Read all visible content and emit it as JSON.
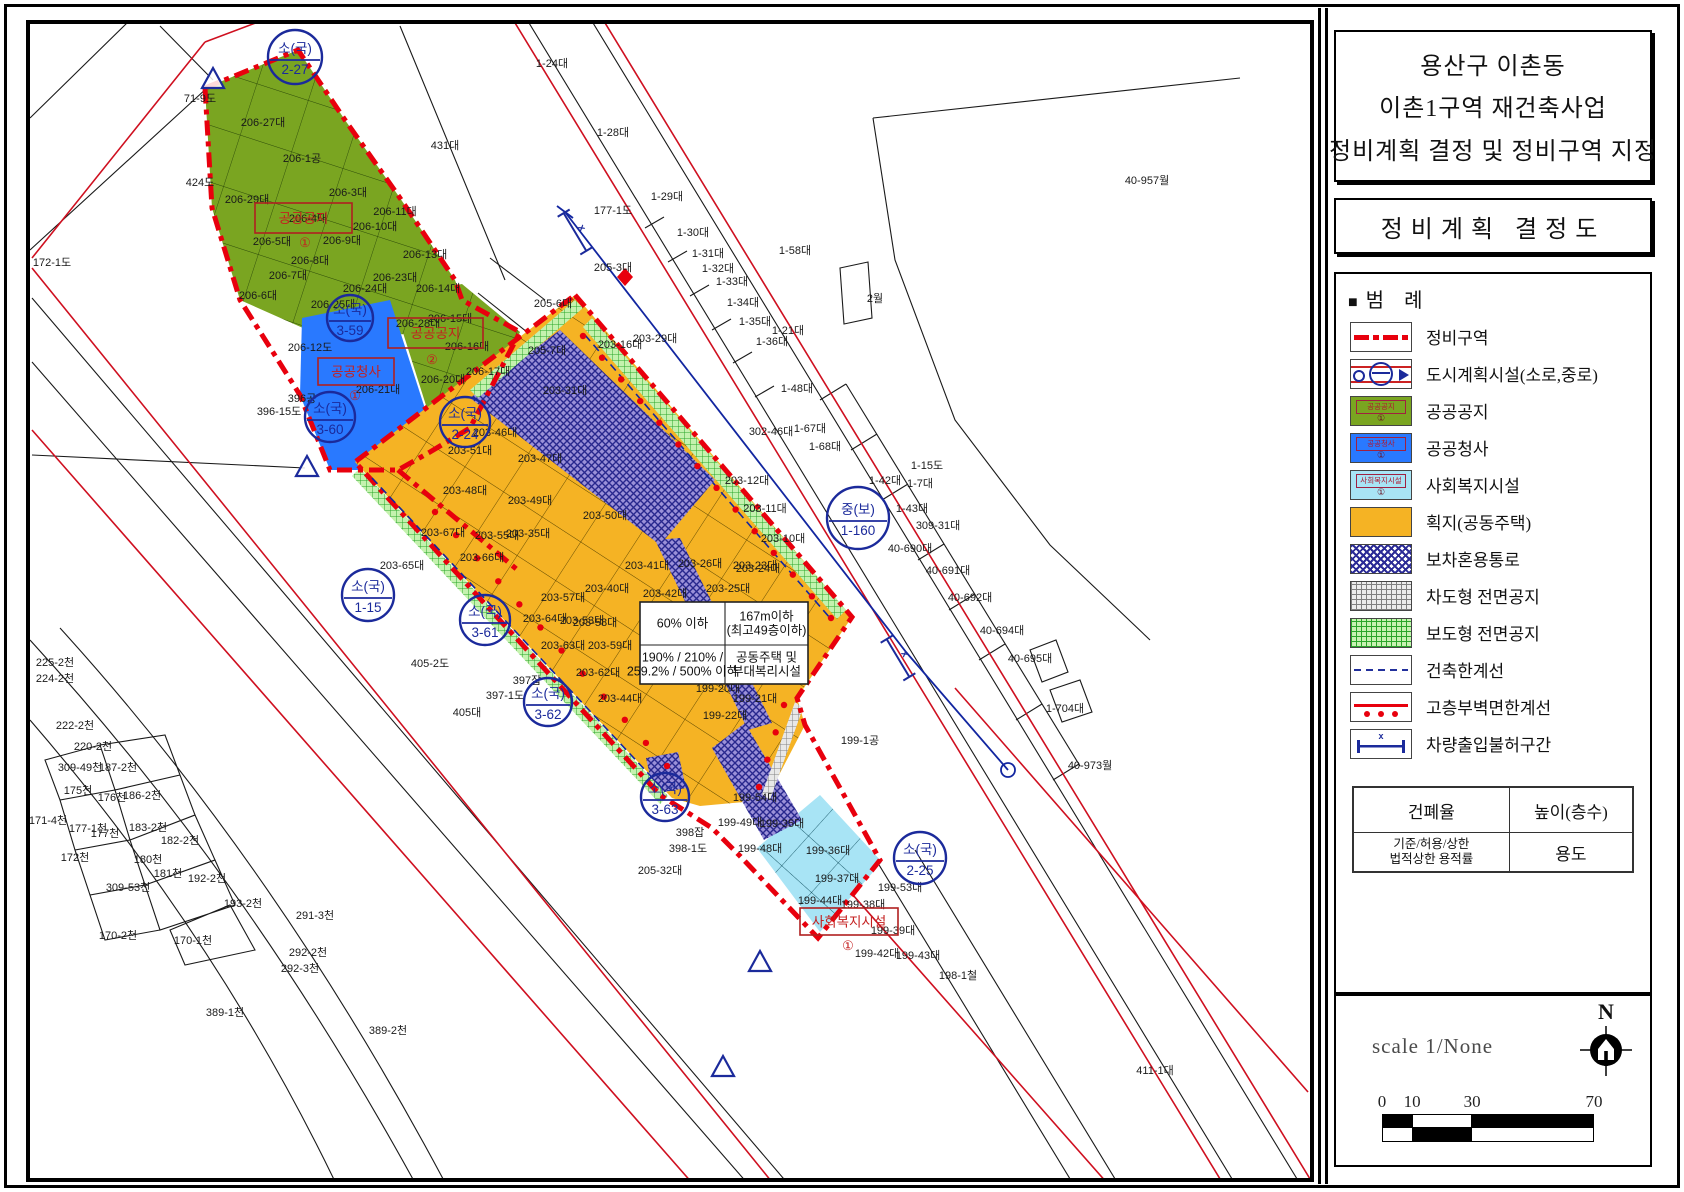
{
  "panel": {
    "title_lines": [
      "용산구 이촌동",
      "이촌1구역 재건축사업",
      "정비계획 결정 및 정비구역 지정"
    ],
    "subtitle": "정비계획 결정도",
    "legend_header": {
      "marker": "■",
      "label": "범    례"
    },
    "legend_items": [
      {
        "label": "정비구역",
        "type": "redline"
      },
      {
        "label": "도시계획시설(소로,중로)",
        "type": "city"
      },
      {
        "label": "공공공지",
        "type": "fill-green",
        "inner": "공공공지",
        "badge": "①"
      },
      {
        "label": "공공청사",
        "type": "fill-blue",
        "inner": "공공청사",
        "badge": "①"
      },
      {
        "label": "사회복지시설",
        "type": "fill-lblue",
        "inner": "사회복지시설",
        "badge": "①"
      },
      {
        "label": "획지(공동주택)",
        "type": "fill-orange"
      },
      {
        "label": "보차혼용통로",
        "type": "xhatch-blue"
      },
      {
        "label": "차도형 전면공지",
        "type": "grid-gray"
      },
      {
        "label": "보도형 전면공지",
        "type": "grid-green"
      },
      {
        "label": "건축한계선",
        "type": "bluedash"
      },
      {
        "label": "고층부벽면한계선",
        "type": "reddots"
      },
      {
        "label": "차량출입불허구간",
        "type": "bluebar"
      }
    ],
    "table": {
      "r1c1": "건폐율",
      "r1c2": "높이(층수)",
      "r2c1a": "기준/허용/상한",
      "r2c1b": "법적상한 용적률",
      "r2c2": "용도"
    },
    "scale_text": "scale 1/None",
    "north": "N",
    "scalebar": {
      "ticks": [
        {
          "t": "0",
          "p": 0
        },
        {
          "t": "10",
          "p": 14.2
        },
        {
          "t": "30",
          "p": 42.5
        },
        {
          "t": "70",
          "p": 100
        }
      ]
    }
  },
  "colors": {
    "boundary_red": "#e8000d",
    "thin_red": "#cf1020",
    "navy_blue": "#1b2a9b",
    "public_open_green": "#7aa521",
    "public_office_blue": "#2979ff",
    "welfare_lightblue": "#a8e4f5",
    "housing_orange": "#f5b324",
    "mixed_path_purple": "#9a90d8",
    "front_space_green": "#c4f2ae",
    "front_space_gray": "#e8e8e8"
  },
  "map": {
    "info_box": {
      "x": 640,
      "y": 602,
      "w": 168,
      "h": 82,
      "cx": 725,
      "cy": 645,
      "cells": [
        [
          "60% 이하",
          "167m이하\n(최고49층이하)"
        ],
        [
          "190% / 210% /\n259.2% / 500% 이하",
          "공동주택 및\n부대복리시설"
        ]
      ]
    },
    "zone_boxes": [
      {
        "x": 255,
        "y": 203,
        "w": 97,
        "h": 30,
        "label": "공공공지",
        "badge": "①",
        "bx": 305,
        "by": 247
      },
      {
        "x": 388,
        "y": 318,
        "w": 95,
        "h": 30,
        "label": "공공공지",
        "badge": "②",
        "bx": 432,
        "by": 364
      },
      {
        "x": 318,
        "y": 358,
        "w": 76,
        "h": 27,
        "label": "공공청사",
        "badge": "①",
        "bx": 355,
        "by": 400
      },
      {
        "x": 800,
        "y": 908,
        "w": 98,
        "h": 27,
        "label": "사회복지시설",
        "badge": "①",
        "bx": 848,
        "by": 950
      }
    ],
    "circles": [
      [
        295,
        57,
        27,
        "소(국)",
        "2-27"
      ],
      [
        350,
        318,
        23,
        "소(국)",
        "3-59"
      ],
      [
        330,
        417,
        25,
        "소(국)",
        "3-60"
      ],
      [
        465,
        422,
        25,
        "소(국)",
        "2-24"
      ],
      [
        368,
        595,
        26,
        "소(국)",
        "1-15"
      ],
      [
        485,
        620,
        25,
        "소(국)",
        "3-61"
      ],
      [
        548,
        702,
        24,
        "소(국)",
        "3-62"
      ],
      [
        665,
        797,
        24,
        "소(국)",
        "3-63"
      ],
      [
        858,
        518,
        31,
        "중(보)",
        "1-160"
      ],
      [
        920,
        858,
        26,
        "소(국)",
        "2-25"
      ]
    ],
    "triangles": [
      [
        213,
        80
      ],
      [
        307,
        468
      ],
      [
        760,
        963
      ],
      [
        723,
        1068
      ]
    ],
    "xbars": [
      [
        575,
        232,
        59
      ],
      [
        898,
        658,
        59
      ]
    ],
    "dot_lines": [
      [
        594,
        326,
        842,
        608,
        14,
        -11,
        10
      ],
      [
        424,
        522,
        656,
        776,
        12,
        11,
        -10
      ],
      [
        795,
        708,
        770,
        790,
        4,
        -11,
        -3
      ]
    ],
    "parcels": [
      [
        120,
        16,
        "4-22대"
      ],
      [
        540,
        12,
        "6-87대"
      ],
      [
        552,
        63,
        "1-24대"
      ],
      [
        200,
        98,
        "71-9도"
      ],
      [
        445,
        145,
        "431대"
      ],
      [
        613,
        132,
        "1-28대"
      ],
      [
        263,
        122,
        "206-27대"
      ],
      [
        302,
        158,
        "206-1공"
      ],
      [
        247,
        199,
        "206-29대"
      ],
      [
        200,
        182,
        "424도"
      ],
      [
        348,
        192,
        "206-3대"
      ],
      [
        308,
        218,
        "206-4대"
      ],
      [
        395,
        211,
        "206-11대"
      ],
      [
        375,
        226,
        "206-10대"
      ],
      [
        272,
        241,
        "206-5대"
      ],
      [
        342,
        240,
        "206-9대"
      ],
      [
        310,
        260,
        "206-8대"
      ],
      [
        288,
        275,
        "206-7대"
      ],
      [
        425,
        254,
        "206-13대"
      ],
      [
        395,
        277,
        "206-23대"
      ],
      [
        365,
        288,
        "206-24대"
      ],
      [
        438,
        288,
        "206-14대"
      ],
      [
        258,
        295,
        "206-6대"
      ],
      [
        333,
        304,
        "206-25대"
      ],
      [
        450,
        318,
        "206-15대"
      ],
      [
        418,
        323,
        "206-28대"
      ],
      [
        467,
        346,
        "206-16대"
      ],
      [
        488,
        371,
        "206-17대"
      ],
      [
        443,
        379,
        "206-20대"
      ],
      [
        310,
        347,
        "206-12도"
      ],
      [
        378,
        389,
        "206-21대"
      ],
      [
        302,
        398,
        "396공"
      ],
      [
        279,
        411,
        "396-15도"
      ],
      [
        52,
        262,
        "172-1도"
      ],
      [
        613,
        210,
        "177-1도"
      ],
      [
        667,
        196,
        "1-29대"
      ],
      [
        693,
        232,
        "1-30대"
      ],
      [
        708,
        253,
        "1-31대"
      ],
      [
        718,
        268,
        "1-32대"
      ],
      [
        732,
        281,
        "1-33대"
      ],
      [
        743,
        302,
        "1-34대"
      ],
      [
        755,
        321,
        "1-35대"
      ],
      [
        772,
        341,
        "1-36대"
      ],
      [
        788,
        330,
        "1-21대"
      ],
      [
        795,
        250,
        "1-58대"
      ],
      [
        875,
        298,
        "2월"
      ],
      [
        1147,
        180,
        "40-957월"
      ],
      [
        613,
        267,
        "205-3대"
      ],
      [
        553,
        303,
        "205-6대"
      ],
      [
        547,
        350,
        "205-7대"
      ],
      [
        771,
        431,
        "302-46대"
      ],
      [
        810,
        428,
        "1-67대"
      ],
      [
        825,
        446,
        "1-68대"
      ],
      [
        797,
        388,
        "1-48대"
      ],
      [
        927,
        465,
        "1-15도"
      ],
      [
        885,
        480,
        "1-42대"
      ],
      [
        920,
        483,
        "1-7대"
      ],
      [
        912,
        508,
        "1-43대"
      ],
      [
        938,
        525,
        "309-31대"
      ],
      [
        910,
        548,
        "40-690대"
      ],
      [
        948,
        570,
        "40-691대"
      ],
      [
        970,
        597,
        "40-692대"
      ],
      [
        1002,
        630,
        "40-694대"
      ],
      [
        1030,
        658,
        "40-695대"
      ],
      [
        1065,
        708,
        "1-704대"
      ],
      [
        1090,
        765,
        "40-973월"
      ],
      [
        958,
        975,
        "198-1철"
      ],
      [
        1155,
        1070,
        "411-1대"
      ],
      [
        620,
        344,
        "203-16대"
      ],
      [
        655,
        338,
        "203-29대"
      ],
      [
        565,
        390,
        "203-31대"
      ],
      [
        495,
        432,
        "203-46대"
      ],
      [
        470,
        450,
        "203-51대"
      ],
      [
        540,
        458,
        "203-47대"
      ],
      [
        465,
        490,
        "203-48대"
      ],
      [
        530,
        500,
        "203-49대"
      ],
      [
        605,
        515,
        "203-50대"
      ],
      [
        443,
        532,
        "203-67대"
      ],
      [
        497,
        535,
        "203-55대"
      ],
      [
        528,
        533,
        "203-35대"
      ],
      [
        482,
        557,
        "203-66대"
      ],
      [
        402,
        565,
        "203-65대"
      ],
      [
        563,
        597,
        "203-57대"
      ],
      [
        545,
        618,
        "203-64대"
      ],
      [
        582,
        620,
        "203-53대"
      ],
      [
        563,
        645,
        "203-63대"
      ],
      [
        647,
        565,
        "203-41대"
      ],
      [
        700,
        563,
        "203-26대"
      ],
      [
        758,
        568,
        "203-24대"
      ],
      [
        665,
        593,
        "203-42대"
      ],
      [
        728,
        588,
        "203-25대"
      ],
      [
        607,
        588,
        "203-40대"
      ],
      [
        595,
        622,
        "203-58대"
      ],
      [
        610,
        645,
        "203-59대"
      ],
      [
        598,
        672,
        "203-62대"
      ],
      [
        620,
        698,
        "203-44대"
      ],
      [
        765,
        508,
        "203-11대"
      ],
      [
        783,
        538,
        "203-10대"
      ],
      [
        747,
        480,
        "203-12대"
      ],
      [
        755,
        565,
        "203-23대"
      ],
      [
        718,
        688,
        "199-20대"
      ],
      [
        755,
        698,
        "199-21대"
      ],
      [
        725,
        715,
        "199-22대"
      ],
      [
        860,
        740,
        "199-1공"
      ],
      [
        755,
        797,
        "199-54대"
      ],
      [
        740,
        822,
        "199-49대"
      ],
      [
        782,
        823,
        "199-35대"
      ],
      [
        760,
        848,
        "199-48대"
      ],
      [
        828,
        850,
        "199-36대"
      ],
      [
        837,
        878,
        "199-37대"
      ],
      [
        900,
        887,
        "199-53대"
      ],
      [
        820,
        900,
        "199-44대"
      ],
      [
        863,
        904,
        "199-38대"
      ],
      [
        893,
        930,
        "199-39대"
      ],
      [
        877,
        953,
        "199-42대"
      ],
      [
        918,
        955,
        "199-43대"
      ],
      [
        527,
        680,
        "397잡"
      ],
      [
        505,
        695,
        "397-1도"
      ],
      [
        430,
        663,
        "405-2도"
      ],
      [
        467,
        712,
        "405대"
      ],
      [
        688,
        848,
        "398-1도"
      ],
      [
        690,
        832,
        "398잡"
      ],
      [
        660,
        870,
        "205-32대"
      ],
      [
        55,
        662,
        "225-2천"
      ],
      [
        55,
        678,
        "224-2천"
      ],
      [
        75,
        725,
        "222-2천"
      ],
      [
        93,
        746,
        "220-2천"
      ],
      [
        80,
        767,
        "309-49천"
      ],
      [
        118,
        767,
        "187-2천"
      ],
      [
        78,
        790,
        "175천"
      ],
      [
        112,
        797,
        "176천"
      ],
      [
        142,
        795,
        "186-2천"
      ],
      [
        48,
        820,
        "171-4천"
      ],
      [
        88,
        828,
        "177-1천"
      ],
      [
        148,
        827,
        "183-2천"
      ],
      [
        180,
        840,
        "182-2천"
      ],
      [
        105,
        833,
        "177천"
      ],
      [
        75,
        857,
        "172천"
      ],
      [
        148,
        859,
        "180천"
      ],
      [
        168,
        873,
        "181천"
      ],
      [
        207,
        878,
        "192-2천"
      ],
      [
        128,
        887,
        "309-53천"
      ],
      [
        243,
        903,
        "193-2천"
      ],
      [
        118,
        935,
        "170-2천"
      ],
      [
        193,
        940,
        "170-1천"
      ],
      [
        315,
        915,
        "291-3천"
      ],
      [
        308,
        952,
        "292-2천"
      ],
      [
        300,
        968,
        "292-3천"
      ],
      [
        225,
        1012,
        "389-1천"
      ],
      [
        388,
        1030,
        "389-2천"
      ]
    ]
  }
}
